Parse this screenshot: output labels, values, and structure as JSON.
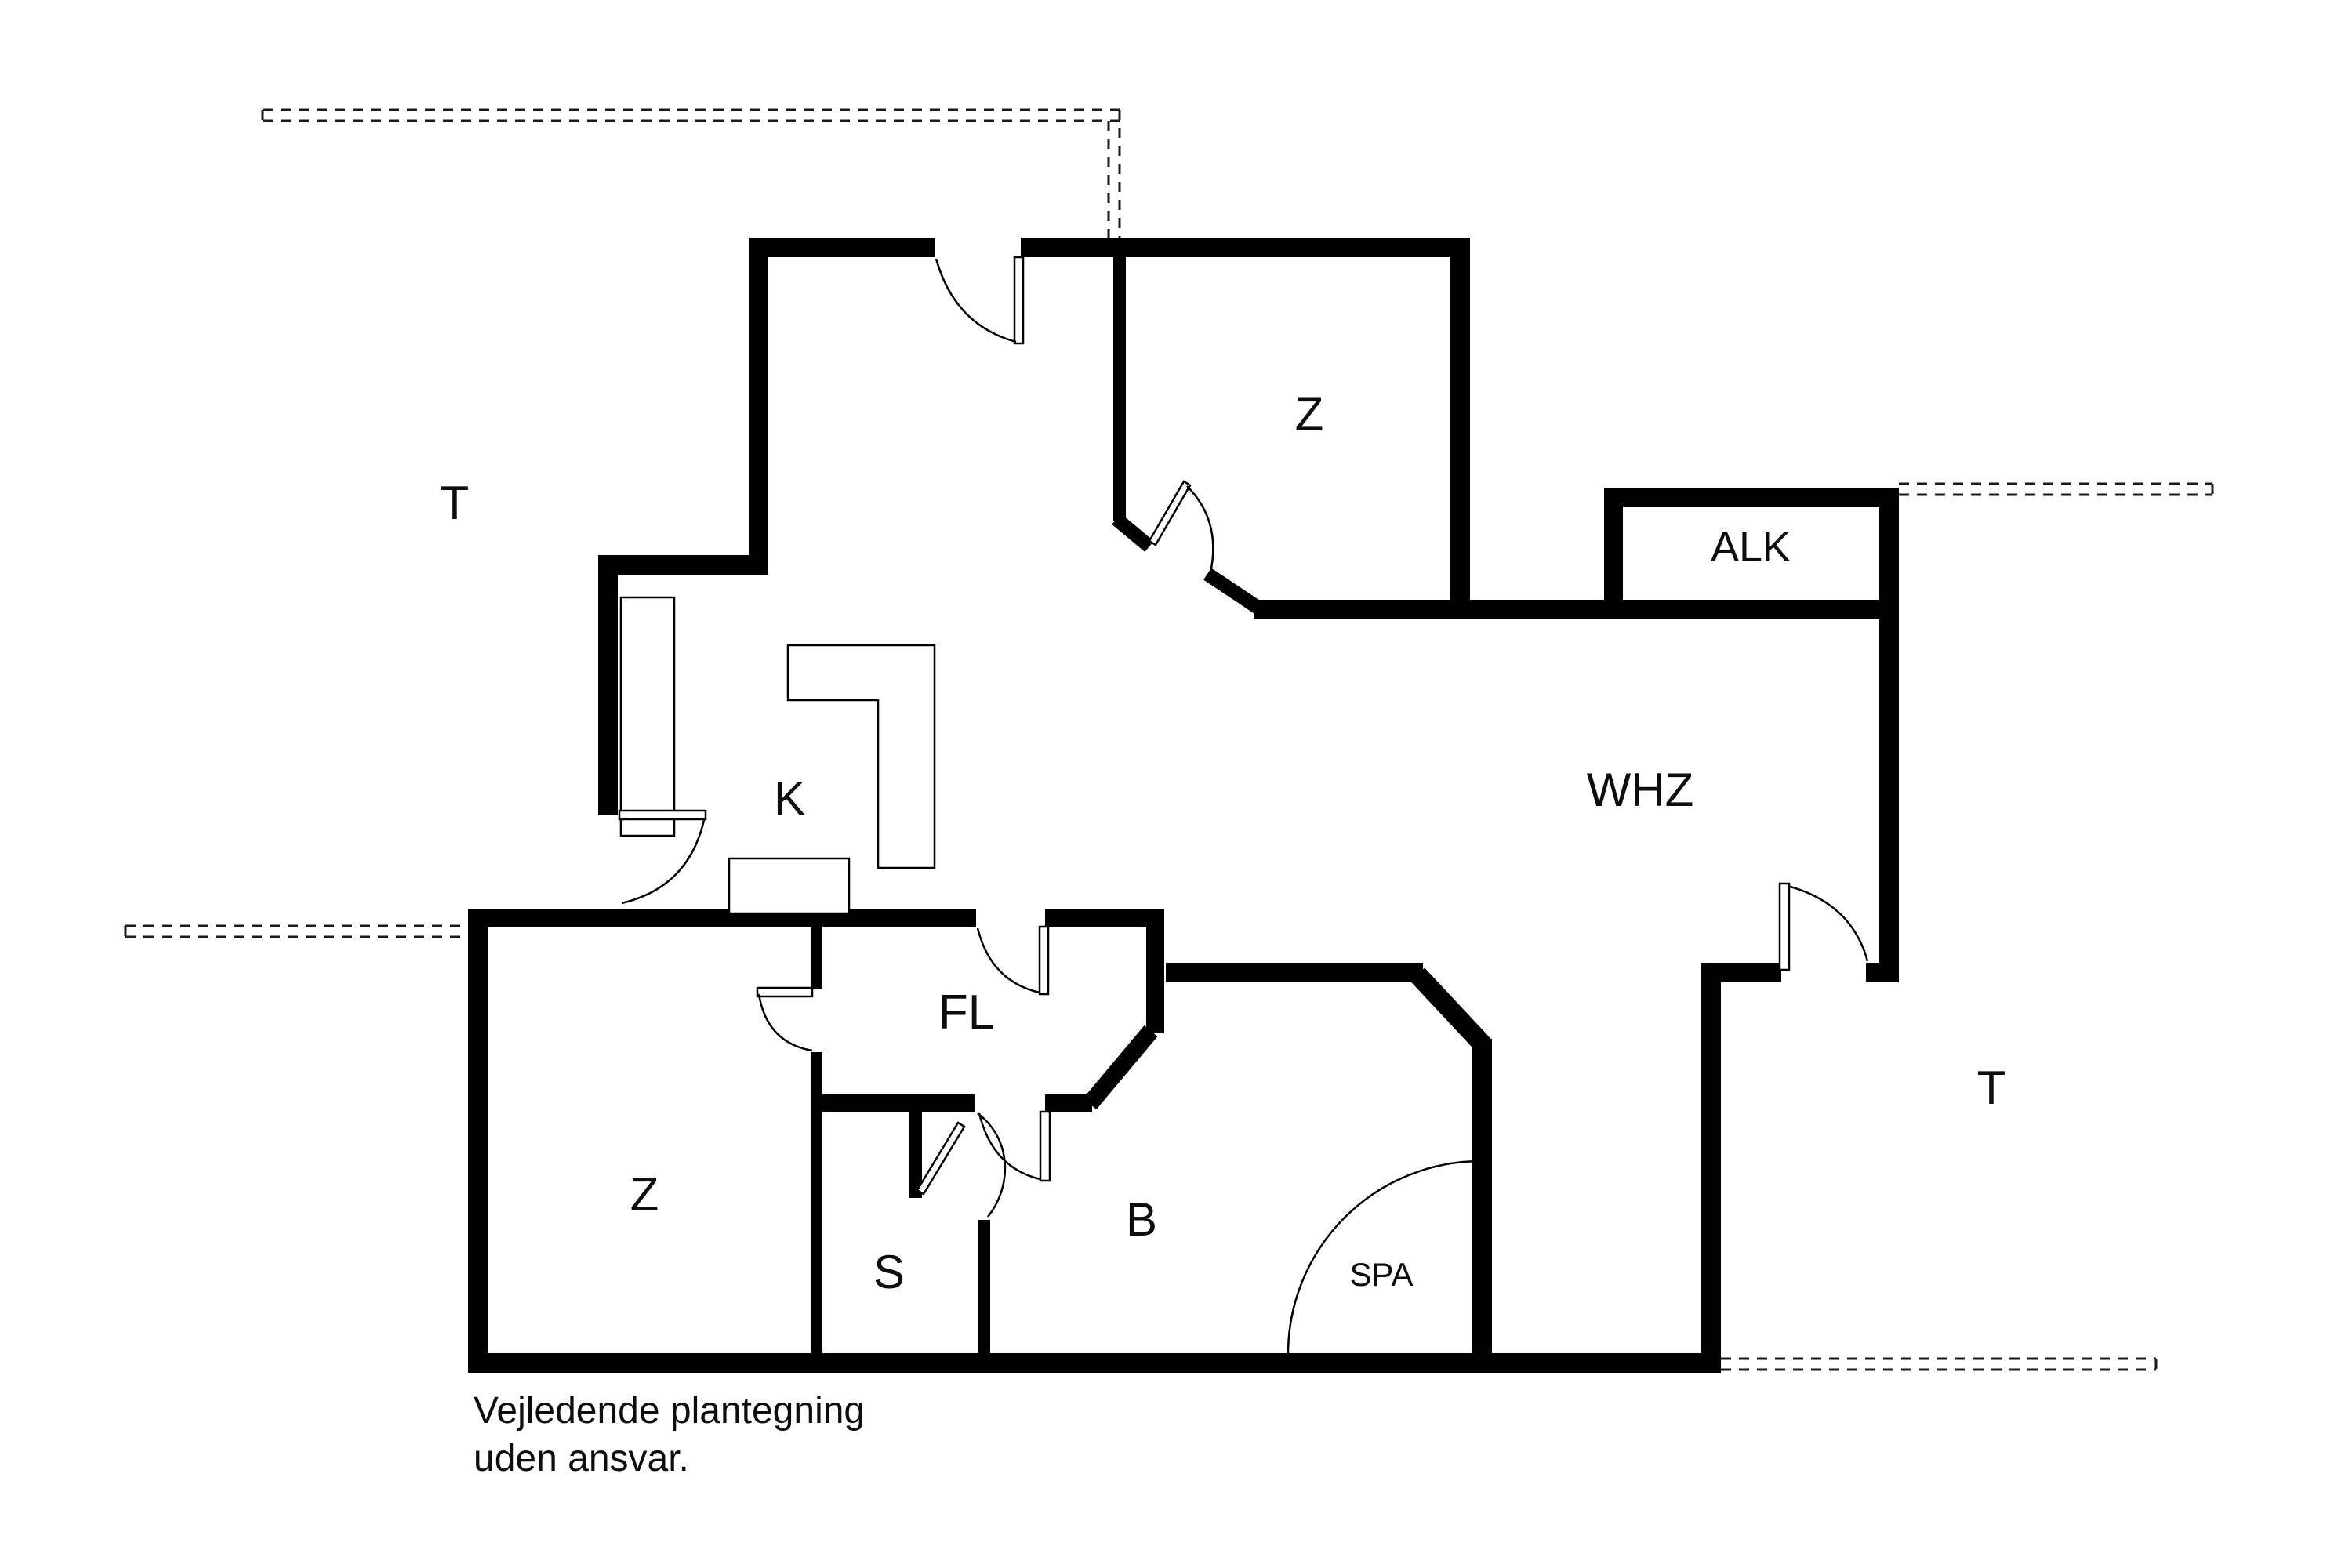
{
  "document": {
    "type": "floor-plan",
    "footer_line1": "Vejledende plantegning",
    "footer_line2": "uden ansvar."
  },
  "labels": {
    "t_top": "T",
    "z_top": "Z",
    "alk": "ALK",
    "whz": "WHZ",
    "k": "K",
    "fl": "FL",
    "z_bottom": "Z",
    "s": "S",
    "b": "B",
    "spa": "SPA",
    "t_right": "T"
  },
  "colors": {
    "wall": "#000000",
    "background": "#ffffff",
    "dashed_line": "#1a1a1a",
    "text": "#0d0d0d"
  }
}
